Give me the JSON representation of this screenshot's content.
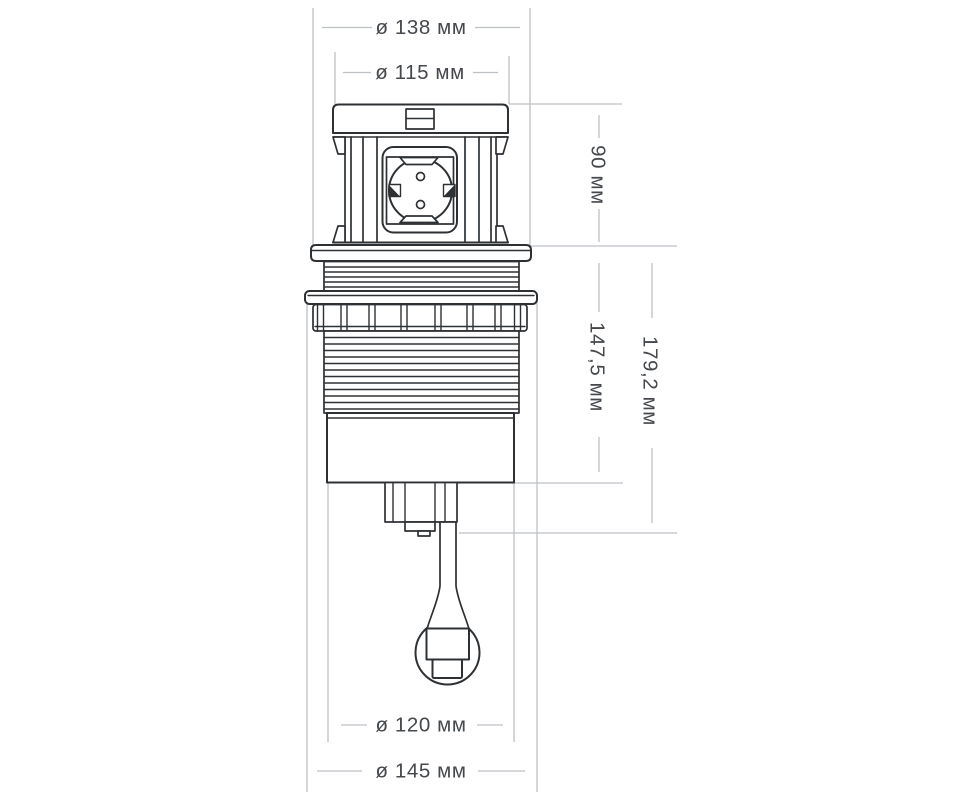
{
  "dimensions": {
    "head_outer_diameter": "ø 138 мм",
    "head_inner_diameter": "ø 115 мм",
    "head_height": "90 мм",
    "body_length": "147,5 мм",
    "total_length": "179,2 мм",
    "body_diameter": "ø 120 мм",
    "flange_diameter": "ø 145 мм"
  },
  "colors": {
    "outline": "#2e3134",
    "dimension_lines": "#bdc1c5",
    "label_text": "#45484c",
    "background": "#ffffff"
  }
}
